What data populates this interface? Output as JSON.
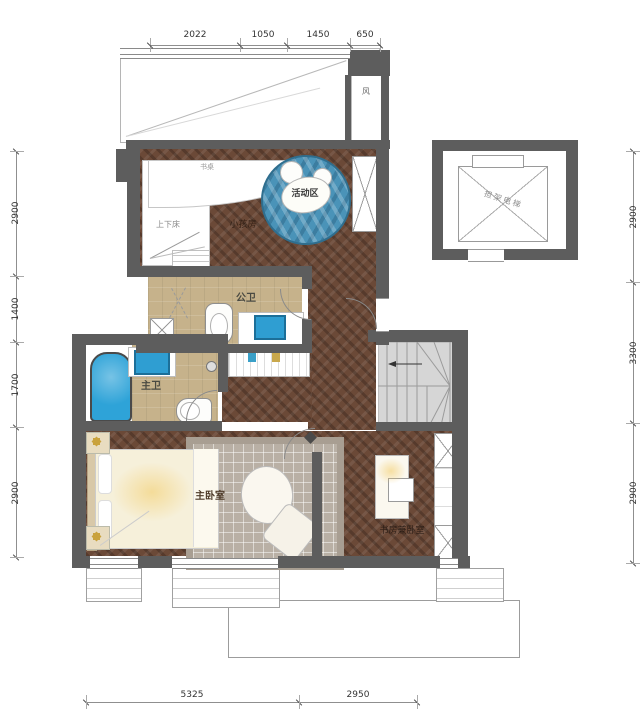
{
  "title": "二层户型平面图",
  "dimensions": {
    "top": [
      "2022",
      "1050",
      "1450",
      "650"
    ],
    "left": [
      "2900",
      "1400",
      "1700",
      "2900"
    ],
    "right": [
      "2900",
      "3300",
      "2900"
    ],
    "bottom": [
      "5325",
      "2950"
    ]
  },
  "labels": {
    "activity_area": "活动区",
    "kids_room": "小孩房",
    "bunk_bed": "上下床",
    "desk": "书桌",
    "public_bathroom": "公卫",
    "master_bathroom": "主卫",
    "master_bedroom": "主卧室",
    "study_bedroom": "书房兼卧室",
    "elevator": "担架电梯",
    "vent_shaft": "风"
  },
  "colors": {
    "wall": "#5d5d5d",
    "wood_floor": "#6b4937",
    "bath_floor": "#c6b28b",
    "water_blue": "#2ea3d8",
    "activity_rug_blue": "#4a93b8",
    "stair_gray": "#d6d6d6",
    "bedroom_rug": "#b9b0a5",
    "gold_accent": "#c9a23c"
  }
}
